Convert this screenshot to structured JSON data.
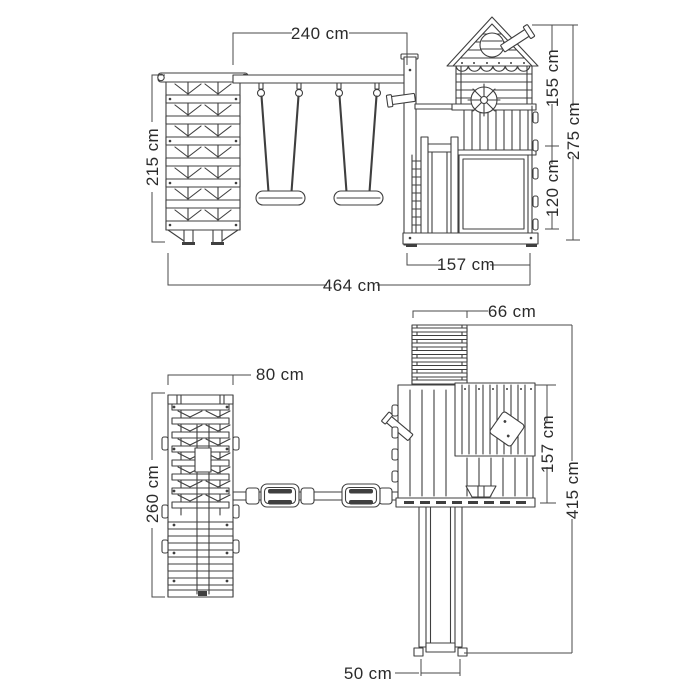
{
  "colors": {
    "line": "#3f3f3f",
    "dim": "#4a4a4a",
    "text": "#2b2b2b",
    "background": "#ffffff"
  },
  "front_view": {
    "dim_beam_width": "240 cm",
    "dim_frame_height": "215 cm",
    "dim_tower_upper_height": "155 cm",
    "dim_total_height": "275 cm",
    "dim_deck_height": "120 cm",
    "dim_tower_width": "157 cm",
    "dim_total_width": "464 cm"
  },
  "plan_view": {
    "dim_ladder_width": "66 cm",
    "dim_frame_width": "80 cm",
    "dim_tower_depth": "157 cm",
    "dim_total_depth": "415 cm",
    "dim_frame_depth": "260 cm",
    "dim_slide_width": "50 cm"
  }
}
